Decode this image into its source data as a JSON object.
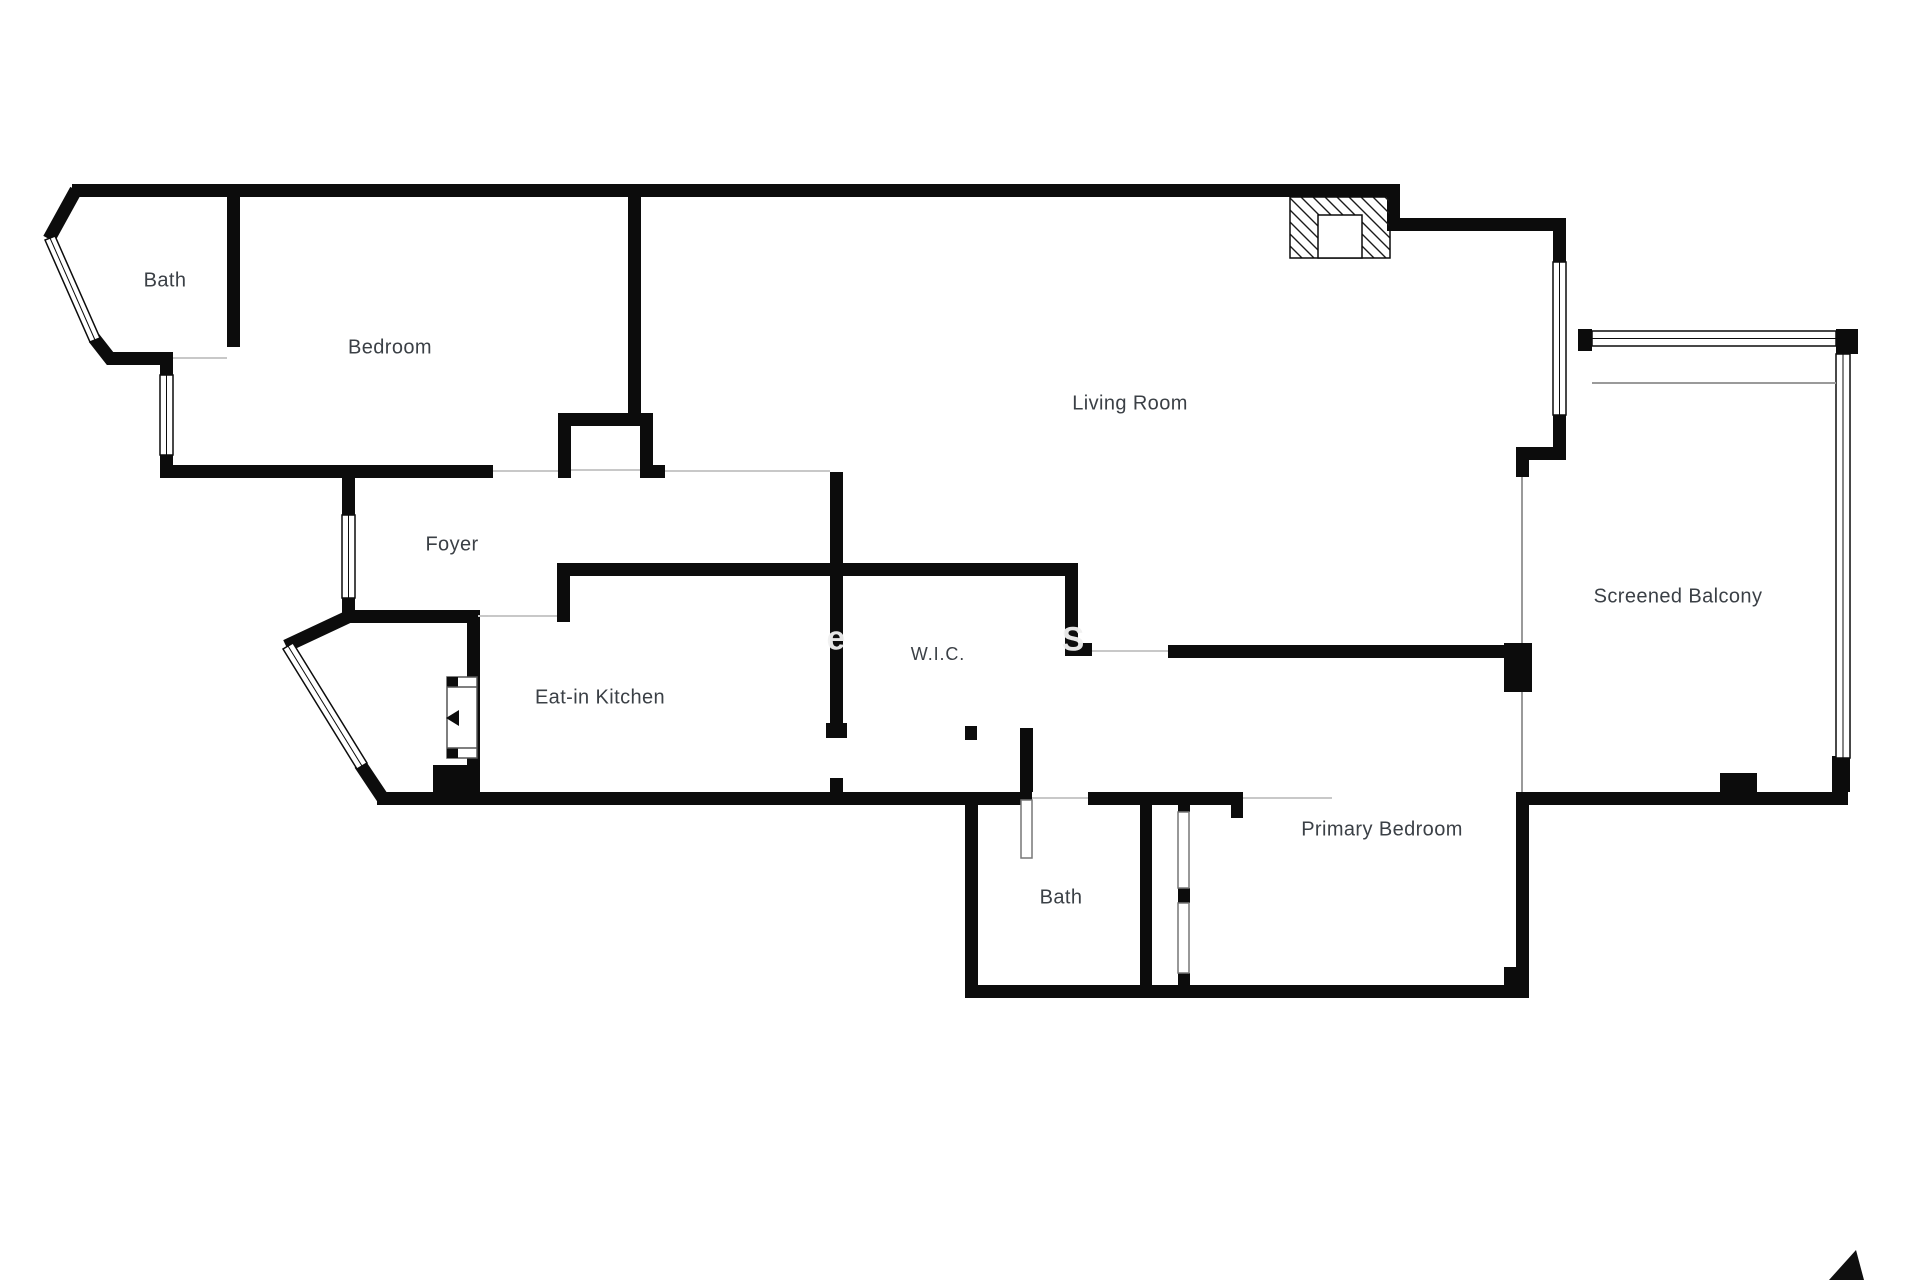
{
  "floorplan": {
    "rooms": [
      {
        "id": "bath-upper",
        "label": "Bath"
      },
      {
        "id": "bedroom",
        "label": "Bedroom"
      },
      {
        "id": "living-room",
        "label": "Living Room"
      },
      {
        "id": "foyer",
        "label": "Foyer"
      },
      {
        "id": "eat-in-kitchen",
        "label": "Eat-in Kitchen"
      },
      {
        "id": "wic",
        "label": "W.I.C."
      },
      {
        "id": "bath-lower",
        "label": "Bath"
      },
      {
        "id": "primary-bedroom",
        "label": "Primary Bedroom"
      },
      {
        "id": "screened-balcony",
        "label": "Screened Balcony"
      }
    ],
    "watermark": {
      "letters": [
        "e",
        "S"
      ]
    },
    "colors": {
      "wall": "#0c0c0c",
      "door_line": "#c8c8c8",
      "window_line": "#0c0c0c",
      "balcony_line": "#9a9a9a",
      "label_text": "#3b4046",
      "background": "#ffffff"
    }
  }
}
